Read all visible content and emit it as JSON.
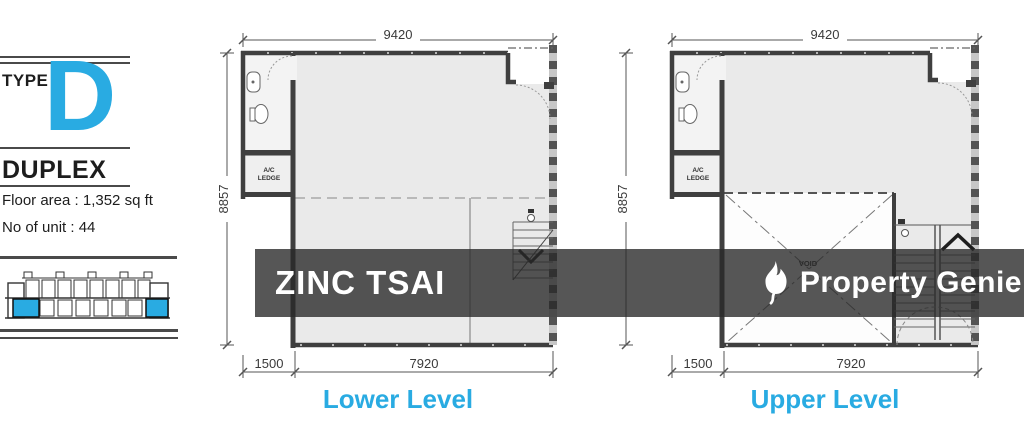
{
  "info_panel": {
    "type_label": "TYPE",
    "type_letter": "D",
    "unit_type": "DUPLEX",
    "floor_area": "Floor area : 1,352 sq ft",
    "unit_count": "No of unit : 44"
  },
  "watermark": {
    "listing_name": "ZINC TSAI",
    "brand_name": "Property Genie"
  },
  "plans": {
    "lower": {
      "label": "Lower Level",
      "dims": {
        "top": "9420",
        "left": "8857",
        "bottom_offset": "1500",
        "bottom_main": "7920"
      },
      "rooms": {
        "ac_line1": "A/C",
        "ac_line2": "LEDGE"
      }
    },
    "upper": {
      "label": "Upper Level",
      "dims": {
        "top": "9420",
        "left": "8857",
        "bottom_offset": "1500",
        "bottom_main": "7920"
      },
      "rooms": {
        "ac_line1": "A/C",
        "ac_line2": "LEDGE",
        "void": "VOID"
      }
    }
  },
  "colors": {
    "accent": "#29ABE2",
    "watermark_band": "rgba(40,40,40,0.79)",
    "wall": "#3f3f3f",
    "floor": "#eaeaea"
  }
}
